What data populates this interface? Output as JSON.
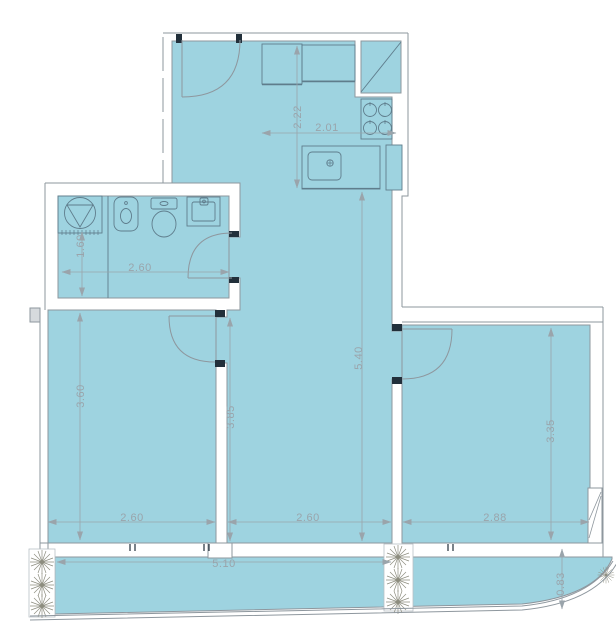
{
  "plan": {
    "kind": "apartment-floor-plan",
    "colors": {
      "floor": "#9ed3e0",
      "wall_line": "#8e979e",
      "fixture_line": "#5f7d8c",
      "dimension": "#9aa4ab",
      "jamb": "#22303b",
      "plant": "#8d8d7f",
      "column_fill": "#d6dadd"
    }
  },
  "dimensions": {
    "kitchen_depth": "2.22",
    "kitchen_width": "2.01",
    "bathroom_depth": "1.60",
    "bathroom_width": "2.60",
    "living_depth": "5.40",
    "center_zone_depth": "3.85",
    "bedroom_left_depth": "3.60",
    "bedroom_left_width": "2.60",
    "living_width": "2.60",
    "bedroom_right_depth": "3.35",
    "bedroom_right_width": "2.88",
    "terrace_width": "5.10",
    "terrace_depth": "0.83"
  },
  "fixtures": {
    "bathroom": [
      "shower",
      "bidet",
      "toilet",
      "washbasin"
    ],
    "kitchen": [
      "counter",
      "duct-shaft",
      "stove-4-burners",
      "sink",
      "appliance"
    ],
    "exterior": [
      "planter-plants",
      "railing",
      "window",
      "column"
    ]
  }
}
